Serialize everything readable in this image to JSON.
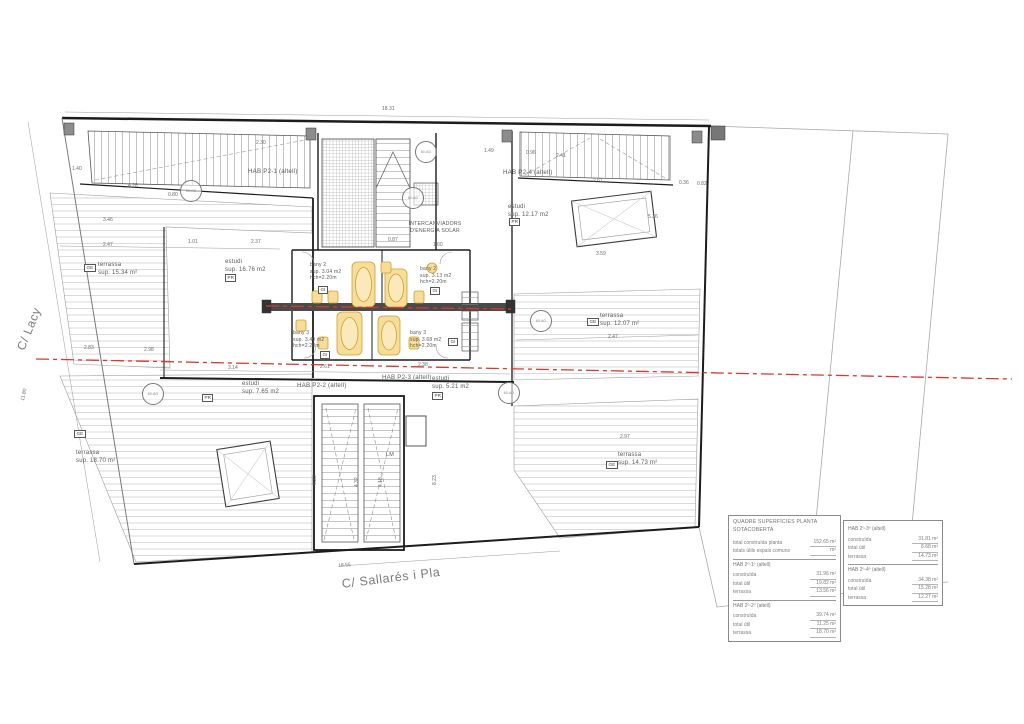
{
  "streets": {
    "left": "C/ Lacy",
    "bottom": "C/ Sallarés i Pla"
  },
  "colors": {
    "axis_red": "#d23b2f",
    "fixture_yellow": "#f7dc9b",
    "fixture_edge": "#c9a227"
  },
  "stamp_text": "60-AG",
  "plan": {
    "labels": [
      {
        "t": "HAB P2-1 (altell)",
        "x": 248,
        "y": 168,
        "fs": 6.2
      },
      {
        "t": "estudi\nsup. 16.76 m2",
        "x": 225,
        "y": 259
      },
      {
        "t": "terrassa\nsup. 15.34 m²",
        "x": 98,
        "y": 262
      },
      {
        "t": "HAB P2-4 (altell)",
        "x": 503,
        "y": 169,
        "fs": 6.2
      },
      {
        "t": "estudi\nsup. 12.17 m2",
        "x": 508,
        "y": 204
      },
      {
        "t": "bany 2\nsup. 3.04 m2\nhch=2.20m",
        "x": 310,
        "y": 262,
        "fs": 5
      },
      {
        "t": "bany 2\nsup. 3.13 m2\nhch=2.20m",
        "x": 420,
        "y": 266,
        "fs": 5
      },
      {
        "t": "bany 3\nsup. 3.40 m2\nhch=2.20m",
        "x": 293,
        "y": 330,
        "fs": 5
      },
      {
        "t": "bany 3\nsup. 3.68 m2\nhch=2.20m",
        "x": 410,
        "y": 330,
        "fs": 5
      },
      {
        "t": "INTERCANVIADORS\nD'ENERGIA SOLAR",
        "x": 407,
        "y": 221,
        "fs": 5.2,
        "w": 56
      },
      {
        "t": "estudi\nsup. 7.65 m2",
        "x": 242,
        "y": 381
      },
      {
        "t": "HAB P2-2 (altell)",
        "x": 297,
        "y": 382,
        "fs": 6.2
      },
      {
        "t": "HAB P2-3 (altell)",
        "x": 382,
        "y": 374,
        "fs": 6.2
      },
      {
        "t": "estudi\nsup. 5.21 m2",
        "x": 432,
        "y": 376
      },
      {
        "t": "terrassa\nsup. 18.70 m²",
        "x": 76,
        "y": 450
      },
      {
        "t": "terrassa\nsup. 12.07 m²",
        "x": 600,
        "y": 313
      },
      {
        "t": "terrassa\nsup. 14.73 m²",
        "x": 618,
        "y": 452
      },
      {
        "t": "LM",
        "x": 386,
        "y": 452,
        "fs": 5.5
      }
    ],
    "tags": [
      {
        "t": "GE",
        "x": 84,
        "y": 264
      },
      {
        "t": "GE",
        "x": 74,
        "y": 430
      },
      {
        "t": "GE",
        "x": 587,
        "y": 318
      },
      {
        "t": "GE",
        "x": 606,
        "y": 461
      },
      {
        "t": "PR",
        "x": 225,
        "y": 274
      },
      {
        "t": "PR",
        "x": 509,
        "y": 218
      },
      {
        "t": "PR",
        "x": 202,
        "y": 394
      },
      {
        "t": "PR",
        "x": 432,
        "y": 392
      },
      {
        "t": "GI",
        "x": 318,
        "y": 286
      },
      {
        "t": "GI",
        "x": 430,
        "y": 287
      },
      {
        "t": "GI",
        "x": 320,
        "y": 351
      },
      {
        "t": "GI",
        "x": 448,
        "y": 338
      }
    ],
    "dims": [
      {
        "t": "18.31",
        "x": 382,
        "y": 106
      },
      {
        "t": "2.30",
        "x": 256,
        "y": 140
      },
      {
        "t": "1.40",
        "x": 72,
        "y": 166
      },
      {
        "t": "4.28",
        "x": 128,
        "y": 183
      },
      {
        "t": "0.80",
        "x": 168,
        "y": 192
      },
      {
        "t": "1.49",
        "x": 484,
        "y": 148
      },
      {
        "t": "0.96",
        "x": 526,
        "y": 150
      },
      {
        "t": "2.41",
        "x": 556,
        "y": 153
      },
      {
        "t": "2.61",
        "x": 593,
        "y": 178
      },
      {
        "t": "0.36",
        "x": 679,
        "y": 180
      },
      {
        "t": "0.82",
        "x": 697,
        "y": 181
      },
      {
        "t": "5.36",
        "x": 648,
        "y": 214
      },
      {
        "t": "3.46",
        "x": 103,
        "y": 217
      },
      {
        "t": "2.47",
        "x": 103,
        "y": 242
      },
      {
        "t": "1.01",
        "x": 188,
        "y": 239
      },
      {
        "t": "2.37",
        "x": 251,
        "y": 239
      },
      {
        "t": "0.87",
        "x": 388,
        "y": 237
      },
      {
        "t": "1.60",
        "x": 433,
        "y": 242
      },
      {
        "t": "3.59",
        "x": 596,
        "y": 251
      },
      {
        "t": "2.83",
        "x": 84,
        "y": 345
      },
      {
        "t": "2.98",
        "x": 144,
        "y": 347
      },
      {
        "t": "2.47",
        "x": 608,
        "y": 334
      },
      {
        "t": "3.14",
        "x": 228,
        "y": 365
      },
      {
        "t": "2.61",
        "x": 320,
        "y": 364
      },
      {
        "t": "2.38",
        "x": 418,
        "y": 362
      },
      {
        "t": "2.97",
        "x": 620,
        "y": 434
      },
      {
        "t": "8.23",
        "x": 312,
        "y": 485,
        "r": -90
      },
      {
        "t": "8.23",
        "x": 432,
        "y": 485,
        "r": -90
      },
      {
        "t": "4.32",
        "x": 354,
        "y": 487,
        "r": -90
      },
      {
        "t": "4.18",
        "x": 378,
        "y": 487,
        "r": -90
      },
      {
        "t": "11.80",
        "x": 20,
        "y": 400,
        "r": -78
      },
      {
        "t": "18.55",
        "x": 338,
        "y": 563,
        "r": -4
      }
    ],
    "stamps": [
      {
        "x": 415,
        "y": 141
      },
      {
        "x": 402,
        "y": 187
      },
      {
        "x": 180,
        "y": 180
      },
      {
        "x": 530,
        "y": 310
      },
      {
        "x": 498,
        "y": 382
      },
      {
        "x": 142,
        "y": 383
      }
    ]
  },
  "table": {
    "title": "QUADRE SUPERFÍCIES PLANTA SOTACOBERTA",
    "totals": [
      {
        "label": "total construïda planta",
        "value": "152.65  m²"
      },
      {
        "label": "totals útils espais comuns",
        "value": "m²"
      }
    ],
    "units": [
      {
        "name": "HAB 2º-1º (altell)",
        "rows": [
          [
            "construïda",
            "31.96 m²"
          ],
          [
            "total útil",
            "19.82 m²"
          ],
          [
            "terrassa",
            "13.56 m²"
          ]
        ]
      },
      {
        "name": "HAB 2º-2º (altell)",
        "rows": [
          [
            "construïda",
            "39.74 m²"
          ],
          [
            "total útil",
            "11.25 m²"
          ],
          [
            "terrassa",
            "18.70 m²"
          ]
        ]
      },
      {
        "name": "HAB 2º-3º (altell)",
        "rows": [
          [
            "construïda",
            "31.81 m²"
          ],
          [
            "total útil",
            "8.68 m²"
          ],
          [
            "terrassa",
            "14.73 m²"
          ]
        ]
      },
      {
        "name": "HAB 2º-4º (altell)",
        "rows": [
          [
            "construïda",
            "34.38 m²"
          ],
          [
            "total útil",
            "15.28 m²"
          ],
          [
            "terrassa",
            "12.27 m²"
          ]
        ]
      }
    ]
  }
}
